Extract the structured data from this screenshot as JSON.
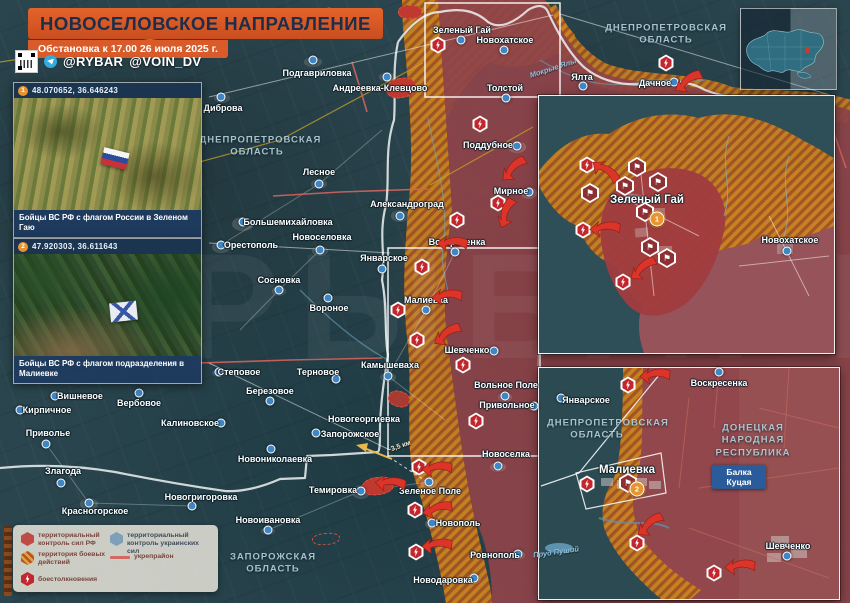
{
  "banner": {
    "title": "НОВОСЕЛОВСКОЕ НАПРАВЛЕНИЕ",
    "subtitle": "Обстановка к 17.00 26 июля 2025 г."
  },
  "social": {
    "handle1": "@RYBAR",
    "handle2": "@VOIN_DV"
  },
  "photos": [
    {
      "id": "1",
      "coords": "48.070652, 36.646243",
      "caption": "Бойцы ВС РФ с флагом России в Зеленом Гаю"
    },
    {
      "id": "2",
      "coords": "47.920303, 36.611643",
      "caption": "Бойцы ВС РФ с флагом подразделения в Малиевке"
    }
  ],
  "legend": {
    "rf": "территориальный контроль сил РФ",
    "battle": "территория боевых действий",
    "ua": "территориальный контроль украинских сил",
    "fort": "укрепрайон",
    "clash": "боестолкновения"
  },
  "colors": {
    "banner_orange": "#D95B29",
    "rf_red": "#8E4449",
    "battle_orange": "#C9841F",
    "ua_blue": "#7E9FB8",
    "arrow_red": "#DC3428",
    "marker_orange": "#E8952F",
    "dot_blue": "#3E86C6"
  },
  "map": {
    "watermark": "РЫБАРЬ",
    "distance_label": "~3,5 км",
    "region_labels": [
      {
        "text": "ДНЕПРОПЕТРОВСКАЯ ОБЛАСТЬ",
        "x": 257,
        "y": 147,
        "w": 115
      },
      {
        "text": "ДНЕПРОПЕТРОВСКАЯ ОБЛАСТЬ",
        "x": 666,
        "y": 35,
        "w": 135
      },
      {
        "text": "ЗАПОРОЖСКАЯ ОБЛАСТЬ",
        "x": 273,
        "y": 564,
        "w": 105
      }
    ],
    "water_labels": [
      {
        "text": "Мокрые Ялы",
        "x": 553,
        "y": 68,
        "rot": -18
      }
    ],
    "settlements": [
      {
        "n": "Подгавриловка",
        "x": 317,
        "y": 73,
        "dot": [
          313,
          60
        ]
      },
      {
        "n": "Андреевка-Клевцово",
        "x": 380,
        "y": 88,
        "dot": [
          387,
          77
        ]
      },
      {
        "n": "Диброва",
        "x": 223,
        "y": 108,
        "dot": [
          221,
          97
        ]
      },
      {
        "n": "Лесное",
        "x": 319,
        "y": 172,
        "dot": [
          319,
          184
        ]
      },
      {
        "n": "Александроград",
        "x": 407,
        "y": 204,
        "dot": [
          400,
          216
        ]
      },
      {
        "n": "Большемихайловка",
        "x": 288,
        "y": 222,
        "dot": [
          243,
          222
        ]
      },
      {
        "n": "Орестополь",
        "x": 251,
        "y": 245,
        "dot": [
          221,
          245
        ]
      },
      {
        "n": "Новоселовка",
        "x": 322,
        "y": 237,
        "dot": [
          320,
          250
        ]
      },
      {
        "n": "Сосновка",
        "x": 279,
        "y": 280,
        "dot": [
          279,
          290
        ]
      },
      {
        "n": "Вороное",
        "x": 329,
        "y": 308,
        "dot": [
          328,
          298
        ]
      },
      {
        "n": "Январское",
        "x": 384,
        "y": 258,
        "dot": [
          382,
          269
        ]
      },
      {
        "n": "Воскресенка",
        "x": 457,
        "y": 242,
        "dot": [
          455,
          252
        ]
      },
      {
        "n": "Малиевка",
        "x": 426,
        "y": 300,
        "dot": [
          426,
          310
        ]
      },
      {
        "n": "Шевченко",
        "x": 467,
        "y": 350,
        "dot": [
          494,
          351
        ]
      },
      {
        "n": "Камышеваха",
        "x": 390,
        "y": 365,
        "dot": [
          388,
          376
        ]
      },
      {
        "n": "Вольное Поле",
        "x": 506,
        "y": 385,
        "dot": [
          505,
          396
        ]
      },
      {
        "n": "Привольное",
        "x": 507,
        "y": 405,
        "dot": [
          534,
          406
        ]
      },
      {
        "n": "Степовое",
        "x": 239,
        "y": 372,
        "dot": [
          219,
          372
        ]
      },
      {
        "n": "Терновое",
        "x": 318,
        "y": 372,
        "dot": [
          336,
          379
        ]
      },
      {
        "n": "Вишневое",
        "x": 80,
        "y": 396,
        "dot": [
          55,
          396
        ]
      },
      {
        "n": "Вербовое",
        "x": 139,
        "y": 403,
        "dot": [
          139,
          393
        ]
      },
      {
        "n": "Березовое",
        "x": 270,
        "y": 391,
        "dot": [
          270,
          401
        ]
      },
      {
        "n": "Кирпичное",
        "x": 47,
        "y": 410,
        "dot": [
          20,
          410
        ]
      },
      {
        "n": "Калиновское",
        "x": 190,
        "y": 423,
        "dot": [
          221,
          423
        ]
      },
      {
        "n": "Приволье",
        "x": 48,
        "y": 433,
        "dot": [
          46,
          444
        ]
      },
      {
        "n": "Новониколаевка",
        "x": 275,
        "y": 459,
        "dot": [
          271,
          449
        ]
      },
      {
        "n": "Злагода",
        "x": 63,
        "y": 471,
        "dot": [
          61,
          483
        ]
      },
      {
        "n": "Новогригоровка",
        "x": 201,
        "y": 497,
        "dot": [
          192,
          506
        ]
      },
      {
        "n": "Красногорское",
        "x": 95,
        "y": 511,
        "dot": [
          89,
          503
        ]
      },
      {
        "n": "Новоивановка",
        "x": 268,
        "y": 520,
        "dot": [
          268,
          530
        ]
      },
      {
        "n": "Новогеоргиевка",
        "x": 364,
        "y": 419
      },
      {
        "n": "Запорожское",
        "x": 350,
        "y": 434,
        "dot": [
          316,
          433
        ]
      },
      {
        "n": "Темировка",
        "x": 333,
        "y": 490,
        "dot": [
          361,
          491
        ]
      },
      {
        "n": "Зеленое Поле",
        "x": 430,
        "y": 491,
        "dot": [
          429,
          482
        ]
      },
      {
        "n": "Новоселка",
        "x": 506,
        "y": 454,
        "dot": [
          498,
          466
        ]
      },
      {
        "n": "Новополь",
        "x": 458,
        "y": 523,
        "dot": [
          432,
          523
        ]
      },
      {
        "n": "Ровнополь",
        "x": 495,
        "y": 555,
        "dot": [
          518,
          554
        ]
      },
      {
        "n": "Новодаровка",
        "x": 443,
        "y": 580,
        "dot": [
          474,
          578
        ]
      },
      {
        "n": "Зеленый Гай",
        "x": 462,
        "y": 30,
        "dot": [
          461,
          40
        ]
      },
      {
        "n": "Новохатское",
        "x": 505,
        "y": 40,
        "dot": [
          504,
          50
        ]
      },
      {
        "n": "Толстой",
        "x": 505,
        "y": 88,
        "dot": [
          506,
          98
        ]
      },
      {
        "n": "Поддубное",
        "x": 488,
        "y": 145,
        "dot": [
          517,
          146
        ]
      },
      {
        "n": "Мирное",
        "x": 511,
        "y": 191,
        "dot": [
          529,
          192
        ]
      },
      {
        "n": "Ялта",
        "x": 582,
        "y": 77,
        "dot": [
          583,
          86
        ]
      },
      {
        "n": "Дачное",
        "x": 655,
        "y": 83,
        "dot": [
          674,
          82
        ]
      }
    ],
    "clashes": [
      [
        438,
        45
      ],
      [
        666,
        63
      ],
      [
        480,
        124
      ],
      [
        498,
        203
      ],
      [
        457,
        220
      ],
      [
        422,
        267
      ],
      [
        398,
        310
      ],
      [
        417,
        340
      ],
      [
        463,
        365
      ],
      [
        476,
        421
      ],
      [
        419,
        467
      ],
      [
        415,
        510
      ],
      [
        416,
        552
      ]
    ],
    "arrows": [
      {
        "x": 690,
        "y": 85,
        "r": -30
      },
      {
        "x": 516,
        "y": 172,
        "r": -40
      },
      {
        "x": 510,
        "y": 215,
        "r": -65
      },
      {
        "x": 452,
        "y": 247,
        "r": 5
      },
      {
        "x": 447,
        "y": 300,
        "r": 0
      },
      {
        "x": 449,
        "y": 338,
        "r": -30
      },
      {
        "x": 437,
        "y": 472,
        "r": 0
      },
      {
        "x": 438,
        "y": 513,
        "r": -10
      },
      {
        "x": 437,
        "y": 549,
        "r": 0
      },
      {
        "x": 390,
        "y": 487,
        "r": 8
      }
    ]
  },
  "inset_top": {
    "settlements": [
      {
        "n": "Зеленый Гай",
        "x": 647,
        "y": 200,
        "s": 1
      },
      {
        "n": "Новохатское",
        "x": 790,
        "y": 240,
        "dot": [
          787,
          251
        ]
      }
    ],
    "marker_num": "1",
    "marker_xy": [
      657,
      219
    ],
    "flags": [
      [
        637,
        167
      ],
      [
        625,
        186
      ],
      [
        658,
        182
      ],
      [
        590,
        193
      ],
      [
        645,
        212
      ],
      [
        650,
        247
      ],
      [
        667,
        258
      ]
    ],
    "clashes": [
      [
        587,
        165
      ],
      [
        583,
        230
      ],
      [
        623,
        282
      ]
    ],
    "arrows": [
      {
        "x": 603,
        "y": 174,
        "r": 40
      },
      {
        "x": 605,
        "y": 232,
        "r": 0
      },
      {
        "x": 645,
        "y": 272,
        "r": -35
      }
    ]
  },
  "inset_bottom": {
    "settlements": [
      {
        "n": "Январское",
        "x": 586,
        "y": 400,
        "dot": [
          561,
          398
        ]
      },
      {
        "n": "Воскресенка",
        "x": 719,
        "y": 383,
        "dot": [
          719,
          372
        ]
      },
      {
        "n": "Малиевка",
        "x": 627,
        "y": 470,
        "s": 1
      },
      {
        "n": "Шевченко",
        "x": 788,
        "y": 546,
        "dot": [
          787,
          556
        ]
      }
    ],
    "region_labels": [
      {
        "text": "ДНЕПРОПЕТРОВСКАЯ ОБЛАСТЬ",
        "x": 597,
        "y": 430,
        "w": 100
      },
      {
        "text": "ДОНЕЦКАЯ НАРОДНАЯ РЕСПУБЛИКА",
        "x": 753,
        "y": 441,
        "w": 85
      }
    ],
    "road_sign": "Балка Куцая",
    "water_labels": [
      {
        "text": "Пруд Пуший",
        "x": 556,
        "y": 552,
        "rot": -8
      }
    ],
    "marker_num": "2",
    "marker_xy": [
      637,
      489
    ],
    "flags": [
      [
        628,
        483
      ]
    ],
    "clashes": [
      [
        628,
        385
      ],
      [
        587,
        484
      ],
      [
        637,
        543
      ],
      [
        714,
        573
      ]
    ],
    "arrows": [
      {
        "x": 655,
        "y": 379,
        "r": 0
      },
      {
        "x": 652,
        "y": 528,
        "r": -35
      },
      {
        "x": 740,
        "y": 570,
        "r": 0
      }
    ]
  }
}
